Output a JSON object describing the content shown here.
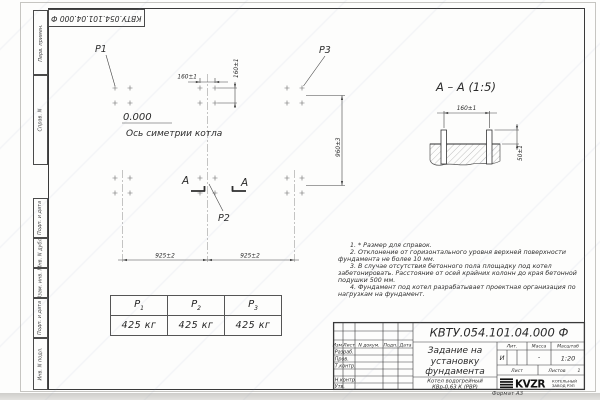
{
  "frame": {
    "stamp_top": "КВТУ.054.101.04.000  Ф",
    "side_labels": [
      "Перв. примен.",
      "Справ. N",
      "Подп. и дата",
      "Инв. N дубл.",
      "Взам. инв. N",
      "Подп. и дата",
      "Инв. N подл."
    ],
    "format_note": "Формат А3"
  },
  "plan": {
    "p1": "Р1",
    "p2": "Р2",
    "p3": "Р3",
    "level": "0.000",
    "axis_label": "Ось симетрии котла",
    "dim_bolt_x": "160±1",
    "dim_bolt_y": "160±1",
    "dim_width": "960±3",
    "dim_span_left": "925±2",
    "dim_span_right": "925±2",
    "section_letter": "А"
  },
  "section": {
    "title": "А – А (1:5)",
    "dim_spacing": "160±1",
    "dim_height": "50±1"
  },
  "notes": [
    "1. * Размер для справок.",
    "2. Отклонение от горизонтального уровня верхней поверхности фундамента не более 10 мм.",
    "3. В случае отсутствия бетонного пола площадку под котел забетонировать. Расстояние от осей крайних колонн до края бетонной подушки 500 мм.",
    "4. Фундамент под котел разрабатывает проектная организация по нагрузкам на фундамент."
  ],
  "load_table": {
    "columns": [
      {
        "name": "Р",
        "sub": "1",
        "value": "425 кг"
      },
      {
        "name": "Р",
        "sub": "2",
        "value": "425 кг"
      },
      {
        "name": "Р",
        "sub": "3",
        "value": "425 кг"
      }
    ]
  },
  "title_block": {
    "doc_number": "КВТУ.054.101.04.000  Ф",
    "title_lines": [
      "Задание на",
      "установку",
      "фундамента"
    ],
    "product_lines": [
      "Котел водогрейный",
      "КВр-0,63 К (РВР)"
    ],
    "header_cells": [
      "Изм.",
      "Лист",
      "N докум.",
      "Подп.",
      "Дата"
    ],
    "roles": [
      "Разраб.",
      "Пров.",
      "Т.контр.",
      "Н.контр.",
      "Утв."
    ],
    "lit_label": "Лит.",
    "mass_label": "Масса",
    "scale_label": "Масштаб",
    "lit_value": "И",
    "mass_value": "-",
    "scale_value": "1:20",
    "sheet_label": "Лист",
    "sheets_label": "Листов",
    "sheets_value": "1",
    "logo_text": "KVZR",
    "logo_sub1": "КОТЕЛЬНЫЙ",
    "logo_sub2": "ЗАВОД РЭП"
  }
}
